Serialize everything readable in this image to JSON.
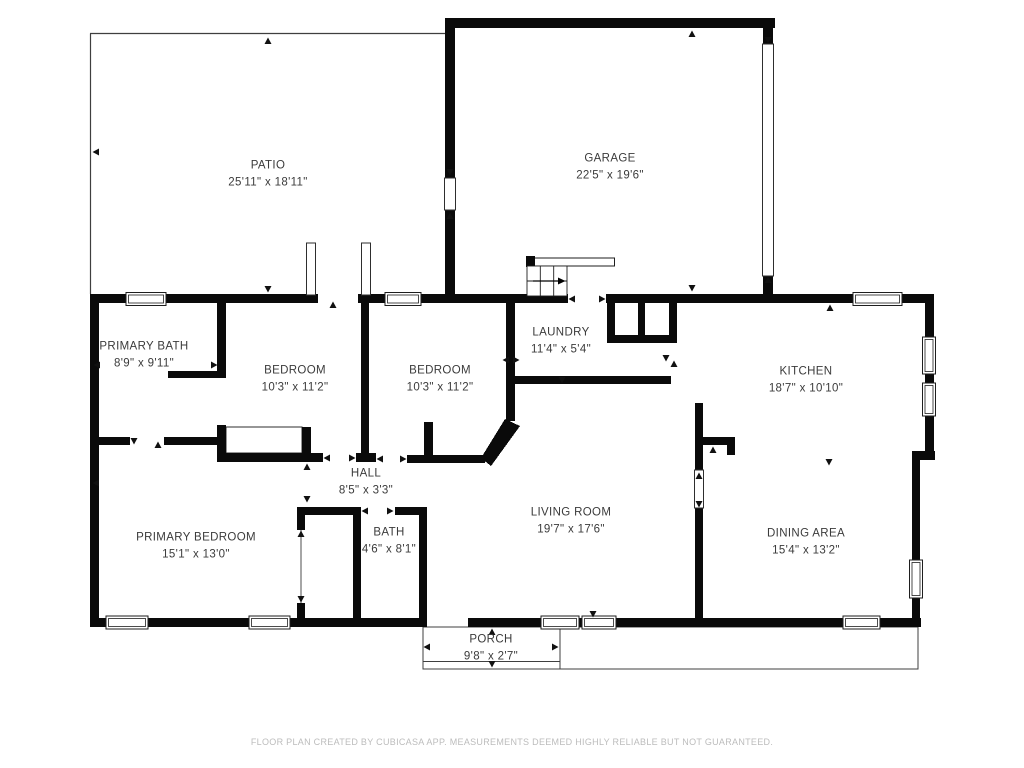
{
  "meta": {
    "type": "floor-plan",
    "creator_note": "FLOOR PLAN CREATED BY CUBICASA APP. MEASUREMENTS DEEMED HIGHLY RELIABLE BUT NOT GUARANTEED."
  },
  "colors": {
    "wall": "#0a0a0a",
    "thin_line": "#3f3f3f",
    "label_text": "#3b3b3b",
    "footer_text": "#bcbcbc",
    "background": "#ffffff"
  },
  "footer": {
    "text": "FLOOR PLAN CREATED BY CUBICASA APP. MEASUREMENTS DEEMED HIGHLY RELIABLE BUT NOT GUARANTEED."
  },
  "rooms": [
    {
      "id": "patio",
      "name": "PATIO",
      "dims": "25'11\" x 18'11\""
    },
    {
      "id": "garage",
      "name": "GARAGE",
      "dims": "22'5\" x 19'6\""
    },
    {
      "id": "primary-bath",
      "name": "PRIMARY BATH",
      "dims": "8'9\" x 9'11\""
    },
    {
      "id": "bedroom-1",
      "name": "BEDROOM",
      "dims": "10'3\" x 11'2\""
    },
    {
      "id": "bedroom-2",
      "name": "BEDROOM",
      "dims": "10'3\" x 11'2\""
    },
    {
      "id": "laundry",
      "name": "LAUNDRY",
      "dims": "11'4\" x 5'4\""
    },
    {
      "id": "kitchen",
      "name": "KITCHEN",
      "dims": "18'7\" x 10'10\""
    },
    {
      "id": "hall",
      "name": "HALL",
      "dims": "8'5\" x 3'3\""
    },
    {
      "id": "living-room",
      "name": "LIVING ROOM",
      "dims": "19'7\" x 17'6\""
    },
    {
      "id": "primary-bedroom",
      "name": "PRIMARY BEDROOM",
      "dims": "15'1\" x 13'0\""
    },
    {
      "id": "bath",
      "name": "BATH",
      "dims": "4'6\" x 8'1\""
    },
    {
      "id": "dining-area",
      "name": "DINING AREA",
      "dims": "15'4\" x 13'2\""
    },
    {
      "id": "porch",
      "name": "PORCH",
      "dims": "9'8\" x 2'7\""
    }
  ]
}
